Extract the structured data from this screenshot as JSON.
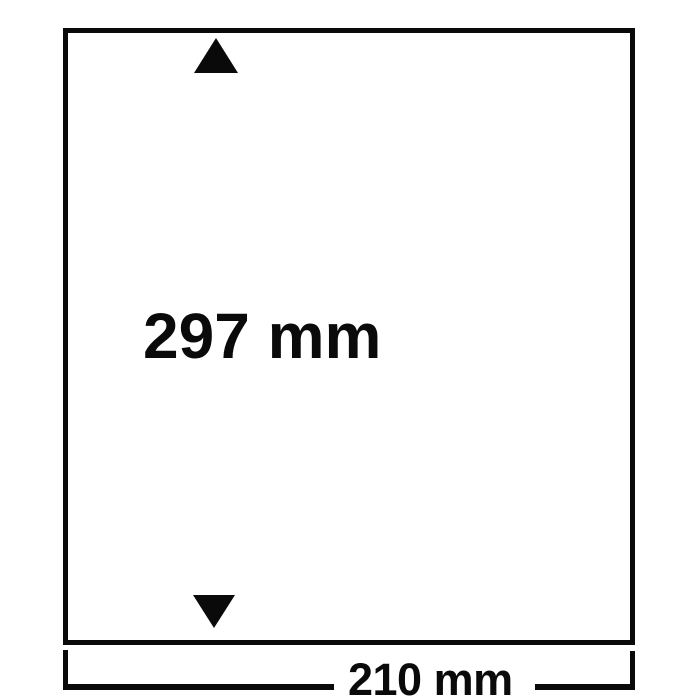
{
  "diagram": {
    "height_label": "297 mm",
    "width_label": "210 mm",
    "markers": {
      "top": "triangle-up",
      "bottom": "triangle-down"
    },
    "colors": {
      "ink": "#0a0a0a",
      "background": "#ffffff"
    }
  }
}
